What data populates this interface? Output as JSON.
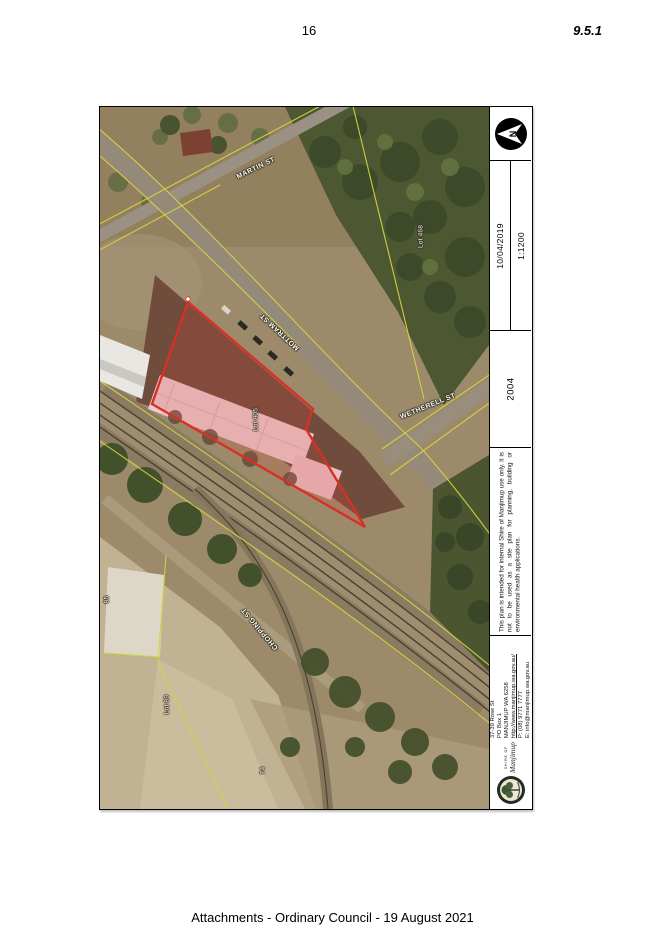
{
  "header": {
    "page_number": "16",
    "item_number": "9.5.1"
  },
  "footer": {
    "text": "Attachments - Ordinary Council - 19 August 2021"
  },
  "map": {
    "streets": {
      "martin": "MARTIN ST",
      "mottram": "MOTTRAM ST",
      "wetherell": "WETHERELL ST",
      "chopping": "CHOPPING ST"
    },
    "lots": {
      "subject": "Lot 905",
      "lot468": "Lot 468",
      "lot89": "Lot 89",
      "lot95": "95",
      "lot74": "74"
    }
  },
  "titleblock": {
    "north": "N",
    "date": "10/04/2019",
    "scale": "1:1200",
    "plan_number": "2004",
    "disclaimer": "This plan is intended for internal Shire of Manjimup use only. It is not to be used as a site plan for planning, building or environmental health applications.",
    "contact": {
      "line1": "37-39 Rose St",
      "line2": "PO Box 1",
      "line3": "MANJIMUP WA 6258",
      "website": "http://www.manjimup.wa.gov.au/",
      "phone": "P: (08) 9771 7777",
      "email": "E: info@manjimup.wa.gov.au",
      "logo_top": "SHIRE OF",
      "logo_name": "Manjimup"
    }
  },
  "colors": {
    "lot_outline": "#d83025",
    "cadastre_yellow": "#d6d33f"
  }
}
